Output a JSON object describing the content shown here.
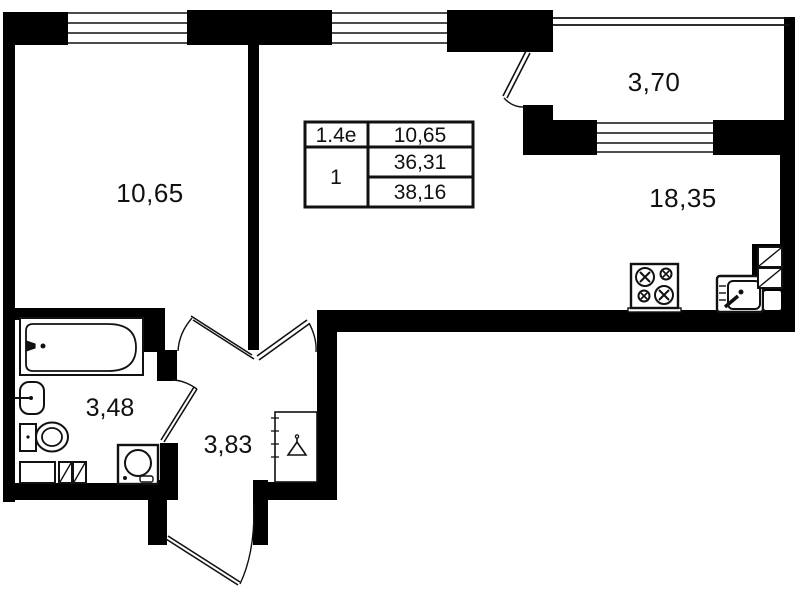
{
  "colors": {
    "wall": "#000000",
    "background": "#ffffff",
    "line": "#111111"
  },
  "rooms": {
    "bedroom": {
      "label": "10,65"
    },
    "balcony": {
      "label": "3,70"
    },
    "kitchen_living": {
      "label": "18,35"
    },
    "bathroom": {
      "label": "3,48"
    },
    "hallway": {
      "label": "3,83"
    }
  },
  "info_table": {
    "unit_code": "1.4e",
    "living_area": "10,65",
    "room_count": "1",
    "area_main": "36,31",
    "area_total": "38,16"
  },
  "fixtures": [
    "bathtub",
    "wash-basin",
    "toilet",
    "washing-machine",
    "stove",
    "kitchen-sink",
    "wardrobe",
    "ventilation-shaft",
    "entrance-door"
  ]
}
